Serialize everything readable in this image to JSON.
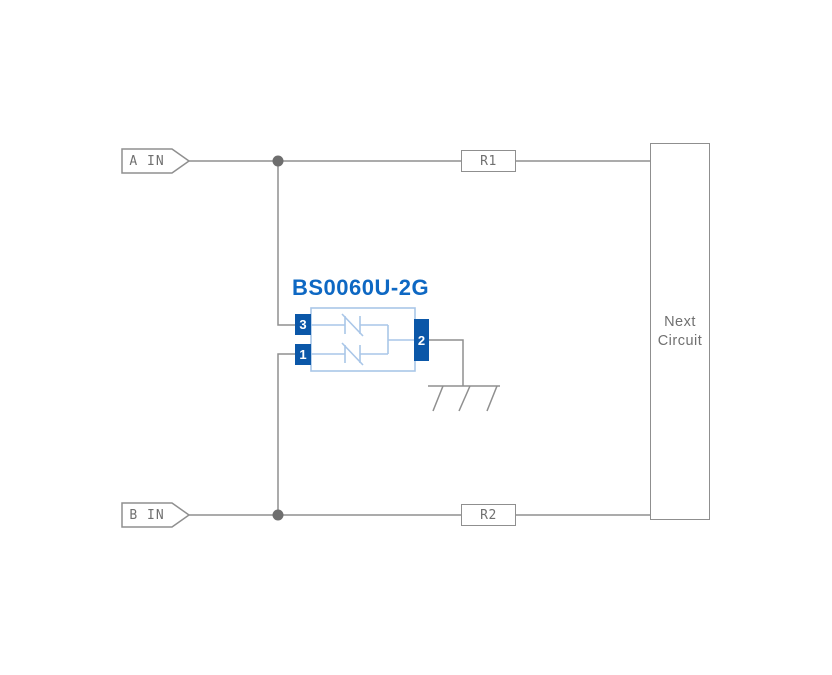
{
  "io": {
    "a_in": "A IN",
    "b_in": "B IN"
  },
  "resistors": {
    "r1": "R1",
    "r2": "R2"
  },
  "next_circuit": {
    "line1": "Next",
    "line2": "Circuit"
  },
  "component": {
    "part_number": "BS0060U-2G",
    "pins": {
      "pin3": "3",
      "pin1": "1",
      "pin2": "2"
    }
  },
  "icons": {
    "ground": "chassis-ground-icon",
    "junction_a": "junction-dot-icon",
    "junction_b": "junction-dot-icon",
    "a_tag": "signal-tag-icon",
    "b_tag": "signal-tag-icon",
    "esd_pair": "bidirectional-suppressor-pair-icon"
  },
  "colors": {
    "wire": "#8F8F8F",
    "junction_dot": "#6E6E6E",
    "label_text": "#707070",
    "pin_fill": "#0B57A8",
    "pin_text": "#FFFFFF",
    "component_outline": "#A9C6E8",
    "part_number": "#0E68C3",
    "background": "#FFFFFF"
  }
}
